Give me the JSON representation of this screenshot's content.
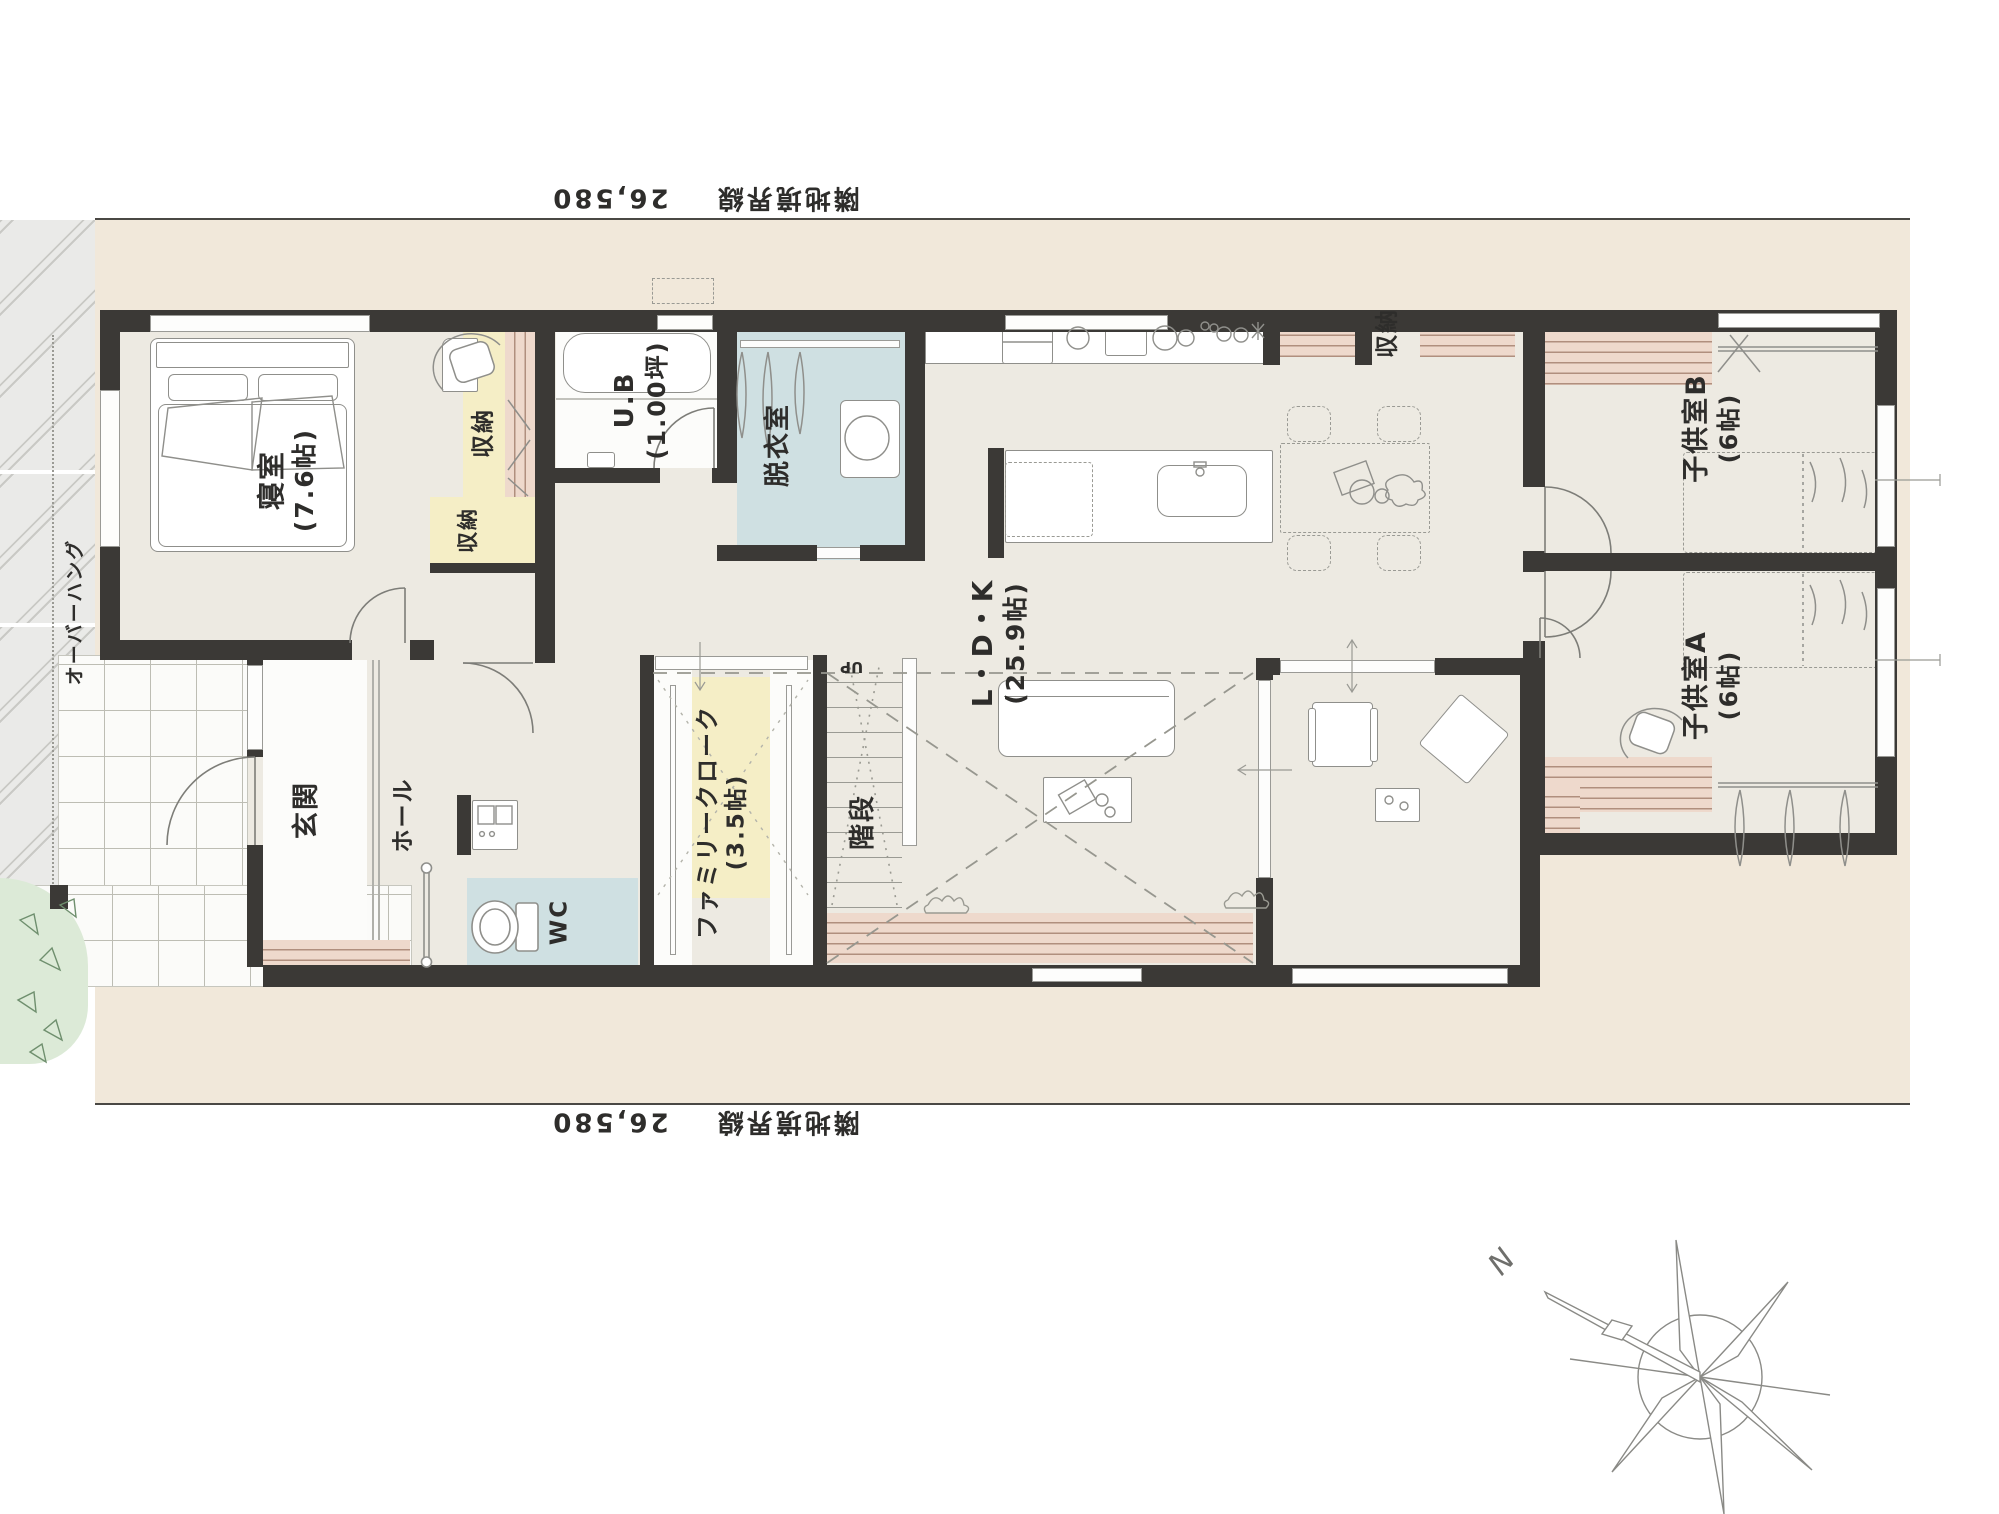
{
  "plan": {
    "boundaries": {
      "top": {
        "label": "隣地境界線",
        "dimension": "26,580"
      },
      "bottom": {
        "label": "隣地境界線",
        "dimension": "26,580"
      }
    },
    "exterior": {
      "overhang": "オーバーハング"
    },
    "compass": {
      "north": "N"
    },
    "rooms": {
      "bedroom": {
        "name": "寝室",
        "area": "(7.6帖)"
      },
      "bedroom_closet": {
        "name": "収納"
      },
      "hall_closet": {
        "name": "収納"
      },
      "unit_bath": {
        "name": "U.B",
        "area": "(1.00坪)"
      },
      "dressing": {
        "name": "脱衣室"
      },
      "entrance": {
        "name": "玄関"
      },
      "hall": {
        "name": "ホール"
      },
      "wc": {
        "name": "WC"
      },
      "family_closet": {
        "name": "ファミリークローク",
        "area": "(3.5帖)"
      },
      "stairs": {
        "name": "階段",
        "direction": "UP"
      },
      "ldk": {
        "name": "L・D・K",
        "area": "(25.9帖)"
      },
      "kitchen_storage": {
        "name": "収納"
      },
      "kids_b": {
        "name": "子供室B",
        "area": "(6帖)"
      },
      "kids_a": {
        "name": "子供室A",
        "area": "(6帖)"
      }
    },
    "colors": {
      "wall": "#3b3936",
      "lot": "#f1e8da",
      "floor": "#edeae2",
      "wet_room": "#cfe0e2",
      "closet": "#f5eec6",
      "wood_deck": "#eed9cc",
      "wood_line": "#b08f7e",
      "plant": "#dcead7"
    }
  }
}
